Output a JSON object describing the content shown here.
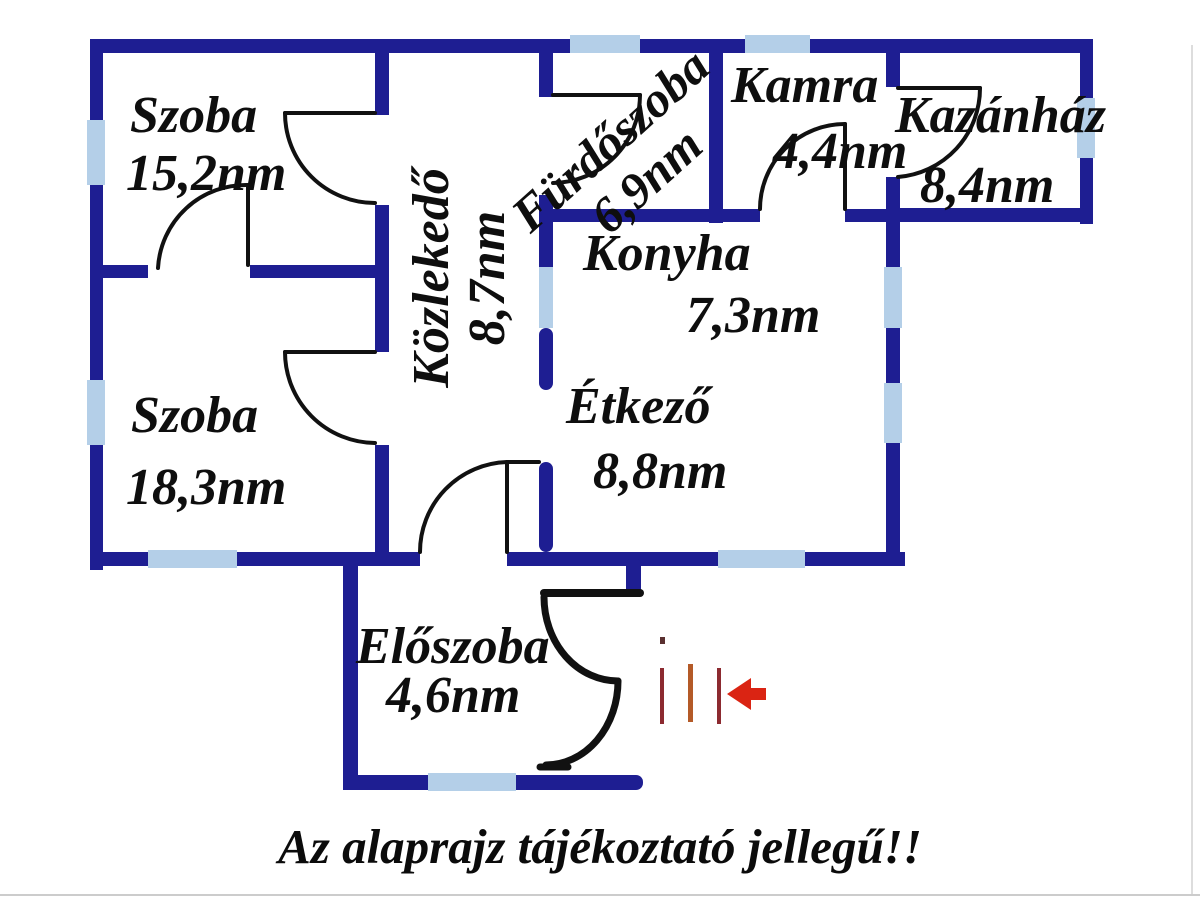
{
  "title": "floor-plan",
  "rooms": [
    {
      "id": "szoba-1",
      "name": "Szoba",
      "area": "15,2nm"
    },
    {
      "id": "szoba-2",
      "name": "Szoba",
      "area": "18,3nm"
    },
    {
      "id": "kozlekedo",
      "name": "Közlekedő",
      "area": "8,7nm"
    },
    {
      "id": "furdoszoba",
      "name": "Fürdőszoba",
      "area": "6,9nm"
    },
    {
      "id": "kamra",
      "name": "Kamra",
      "area": "4,4nm"
    },
    {
      "id": "kazanhaz",
      "name": "Kazánház",
      "area": "8,4nm"
    },
    {
      "id": "konyha",
      "name": "Konyha",
      "area": "7,3nm"
    },
    {
      "id": "etkezo",
      "name": "Étkező",
      "area": "8,8nm"
    },
    {
      "id": "eloszoba",
      "name": "Előszoba",
      "area": "4,6nm"
    }
  ],
  "caption": "Az alaprajz tájékoztató jellegű!!",
  "icons": {
    "entrance_arrow": "left-arrow-icon",
    "entrance_marks": "three-vertical-lines"
  },
  "colors": {
    "wall": "#1e1e92",
    "window": "#b4cfe8",
    "door_line": "#111111",
    "arrow_red": "#da2413",
    "mark_dark_red": "#8c2a30",
    "mark_orange": "#b45a28",
    "text": "#0e0e0e"
  }
}
